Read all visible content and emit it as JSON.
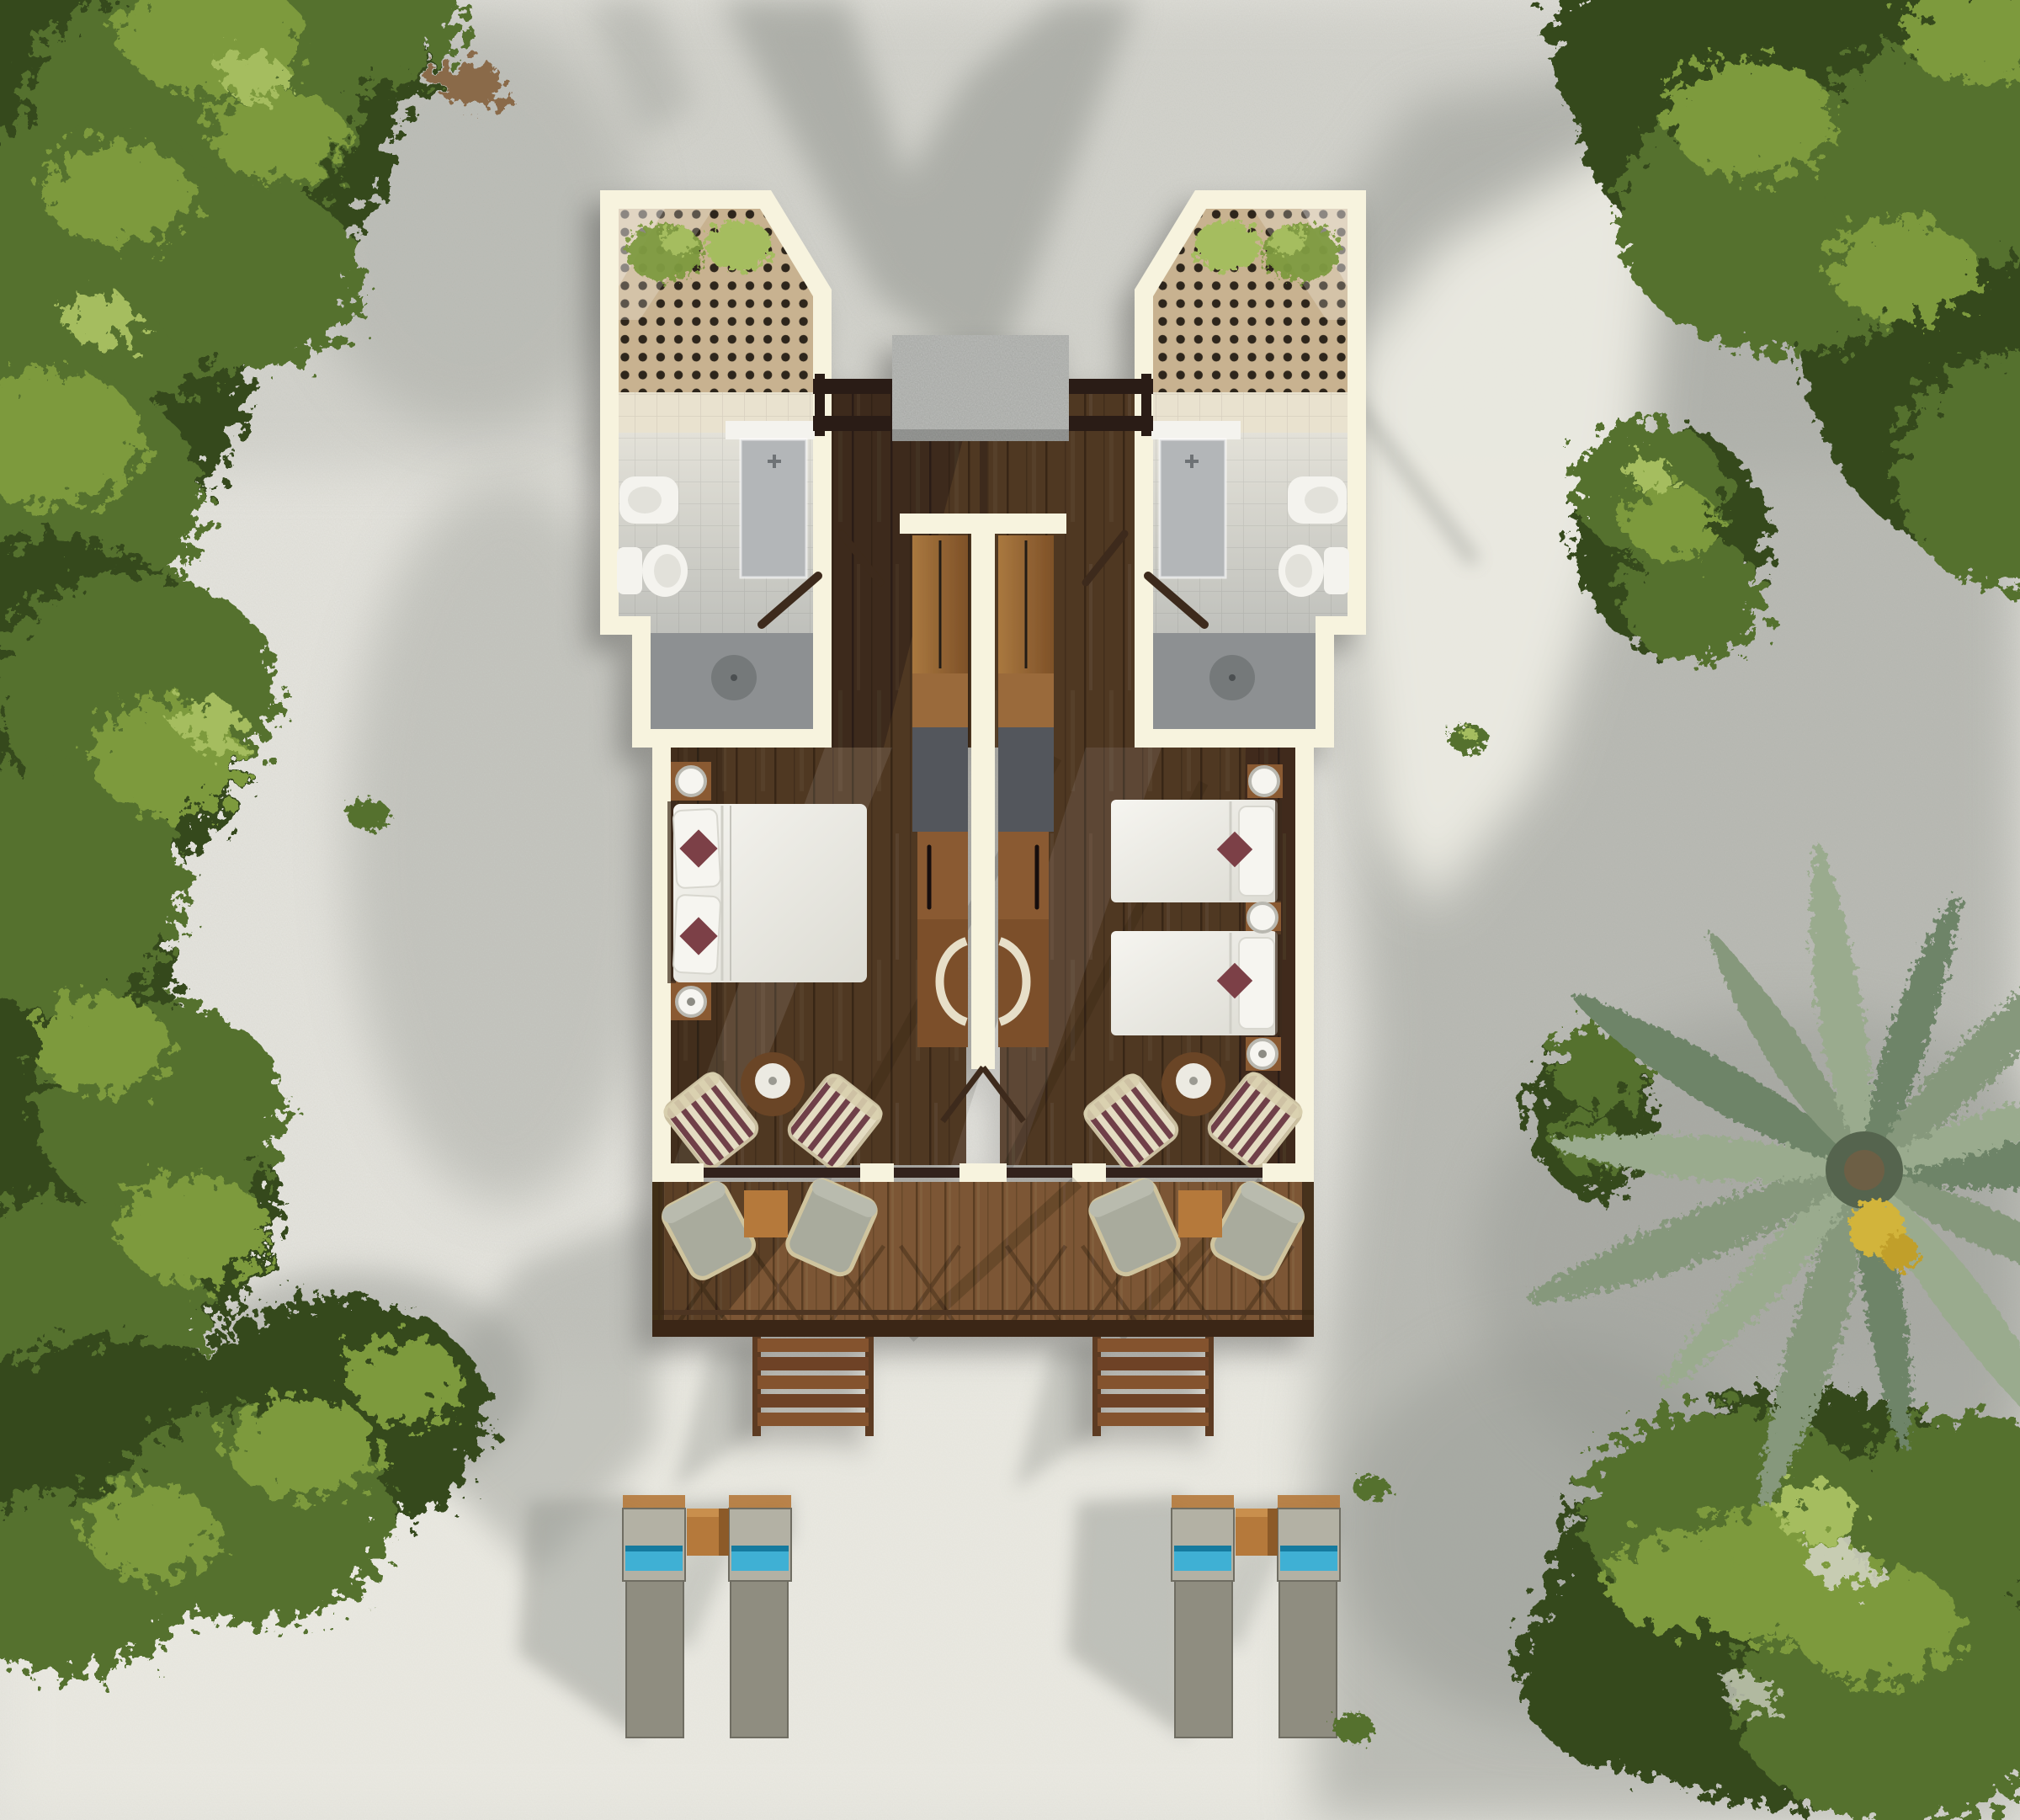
{
  "scene": {
    "type": "architectural-aerial-render",
    "view": "top-down",
    "subject": "Two mirrored beach bungalow guest rooms on white sand, surrounded by tropical trees and a coconut palm",
    "left_unit": {
      "bathroom": [
        "lattice screened courtyard with plants",
        "tiled floor",
        "vanity with basin",
        "bidet",
        "toilet",
        "open shower with round drain",
        "swing door"
      ],
      "bedroom": [
        "double bed with white duvet",
        "2 white pillows",
        "2 dark red accent cushions",
        "2 nightstands with round white lamps"
      ],
      "work_wall": [
        "wardrobe",
        "minibar cabinet",
        "desk with cream chair"
      ],
      "lounge": [
        "2 striped armchairs",
        "round side table"
      ],
      "terrace": [
        "2 sage folding lounge chairs",
        "square timber side table"
      ]
    },
    "right_unit": {
      "bathroom": [
        "lattice screened courtyard with plant",
        "tiled floor",
        "vanity with basin",
        "bidet",
        "toilet",
        "open shower with round drain",
        "swing door"
      ],
      "bedroom": [
        "twin bed 1 with red accent cushion",
        "twin bed 2 with red accent cushion",
        "3 round white bedside lamps"
      ],
      "work_wall": [
        "wardrobe",
        "minibar cabinet",
        "desk with cream chair"
      ],
      "lounge": [
        "2 striped armchairs",
        "round side table"
      ],
      "terrace": [
        "2 sage folding lounge chairs",
        "square timber side table"
      ]
    },
    "shared": {
      "entry": "central timber walkway with pergola beams and grey stone slab",
      "deck": "full-width plank terrace with cross-braced railing",
      "stairs": "2 timber stair flights to the sand",
      "beach": "2 pairs of grey sun loungers with cyan towels and timber side tables"
    },
    "vegetation": [
      "dense tree canopy top-left",
      "shrub strip along left edge",
      "bushes bottom-left",
      "tree canopy top-right",
      "round bush mid-right",
      "coconut palm right",
      "large tree bottom-right",
      "small sand tufts"
    ]
  },
  "colors": {
    "sand": "#d9d8d0",
    "sandBright": "#efeee5",
    "sandShadow": "#969993",
    "wall": "#f7f3de",
    "latticeTan": "#c8b290",
    "latticeDot": "#2e251a",
    "tileBeige": "#e9e2cf",
    "tileGray": "#d7d6cf",
    "showerGray": "#8d9092",
    "drainGray": "#75797a",
    "fixtureWhite": "#f4f3ee",
    "vanityGray": "#b3b6b8",
    "woodDark": "#503823",
    "woodMid": "#6b4b30",
    "beamDark": "#2c1e12",
    "stoneSlab": "#9b9d99",
    "wardrobe": "#9a6a3a",
    "cabinetBrown": "#8a5a30",
    "deskBrown": "#7c4f2c",
    "grayPanel": "#53575b",
    "bedWhite": "#f2f1ea",
    "pillowRed": "#7c3f46",
    "chairStripeCream": "#e4dcc2",
    "chairStripeMaroon": "#6f4049",
    "chairSage": "#a9ab9d",
    "deckBrown": "#7b5634",
    "railDark": "#3b2817",
    "stairBrown": "#84522f",
    "loungerLight": "#b3b1a4",
    "loungerDark": "#8f8d80",
    "towelCyan": "#3fb0d4",
    "towelTeal": "#157a9e",
    "tableWood": "#b5793b",
    "foliageDark": "#35491f",
    "foliageMid": "#55712f",
    "foliageLight": "#7d9a3e",
    "foliageHi": "#a5bd5e",
    "palmA": "#6e8468",
    "palmB": "#86987b",
    "palmC": "#9aab8e",
    "palmCenter": "#55644e",
    "palmYellow": "#d2b43a",
    "lampWhite": "#f6f5f0",
    "creamChair": "#e7dfc8",
    "doorLeaf": "#3d2a1a"
  }
}
